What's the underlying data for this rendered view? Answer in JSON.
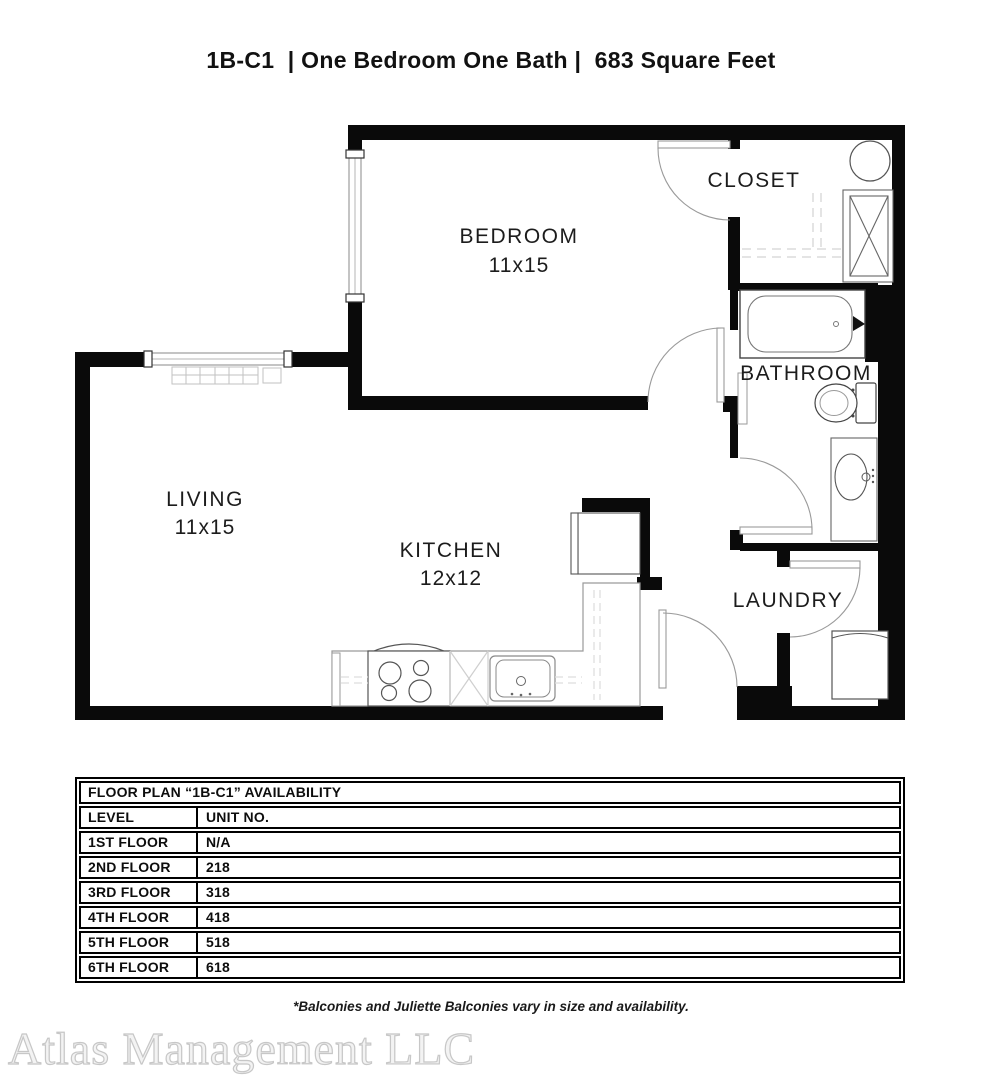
{
  "title": "1B-C1  | One Bedroom One Bath |  683 Square Feet",
  "floor_plan": {
    "rooms": [
      {
        "name": "BEDROOM",
        "dims": "11x15"
      },
      {
        "name": "CLOSET",
        "dims": ""
      },
      {
        "name": "BATHROOM",
        "dims": ""
      },
      {
        "name": "LIVING",
        "dims": "11x15"
      },
      {
        "name": "KITCHEN",
        "dims": "12x12"
      },
      {
        "name": "LAUNDRY",
        "dims": ""
      }
    ],
    "fixture_icons": [
      "bathtub-icon",
      "toilet-icon",
      "bathroom-sink-icon",
      "vanity-icon",
      "stove-icon",
      "dishwasher-icon",
      "kitchen-sink-icon",
      "refrigerator-icon",
      "washer-dryer-icon",
      "water-heater-icon",
      "baseboard-heater-icon",
      "window-icon",
      "door-swing-icon",
      "closet-shelf-icon"
    ],
    "wall_color": "#0a0a0a"
  },
  "availability_table": {
    "title": "FLOOR PLAN “1B-C1” AVAILABILITY",
    "columns": [
      "LEVEL",
      "UNIT NO."
    ],
    "rows": [
      {
        "level": "1ST FLOOR",
        "unit": "N/A"
      },
      {
        "level": "2ND FLOOR",
        "unit": "218"
      },
      {
        "level": "3RD FLOOR",
        "unit": "318"
      },
      {
        "level": "4TH FLOOR",
        "unit": "418"
      },
      {
        "level": "5TH FLOOR",
        "unit": "518"
      },
      {
        "level": "6TH FLOOR",
        "unit": "618"
      }
    ]
  },
  "footnote": "*Balconies and Juliette Balconies vary in size and availability.",
  "watermark": "Atlas Management LLC"
}
